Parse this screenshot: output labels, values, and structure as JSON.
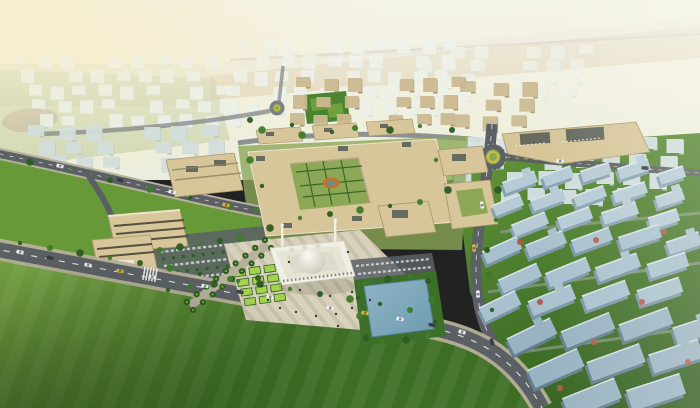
{
  "meta": {
    "type": "architectural-aerial-render",
    "subject": "campus-masterplan-with-central-mosque-plaza-pool-and-residential-districts"
  },
  "palette": {
    "sky_top": "#f5f1dc",
    "sky_low": "#ebeedd",
    "glow": "#f8e9b4",
    "desert": "#d7c6a2",
    "desert_light": "#e8decb",
    "horizon_green": "#ccd2ae",
    "haze": "#f4f3e9",
    "far_wall": "#eaf0ea",
    "far_shade": "#d0ddd8",
    "far_blue": "#d6e2e5",
    "far_blue_shade": "#b7ccd2",
    "midblue_wall": "#d3dfdc",
    "midblue_shade": "#b6c8c6",
    "tan_wall": "#ccba91",
    "tan_shade": "#a6926b",
    "campus_wall": "#d6c69a",
    "campus_shade": "#a8946d",
    "roof_dark": "#666a60",
    "roof_edge": "#ece3c8",
    "grass_campus": "#8ca857",
    "grass_west": "#679939",
    "lawn_hi": "#74a243",
    "lawn_lo": "#3e6d24",
    "resid_hi": "#5f9138",
    "resid_lo": "#2f5c1d",
    "tree_dark": "#2c5c22",
    "tree_mid": "#3f7a2a",
    "lime": "#a6d14d",
    "hedge": "#2f6322",
    "treebed": "#3c6f2a",
    "road": "#5b6065",
    "road_light": "#7b8084",
    "sidewalk": "#b7b09a",
    "path_light": "#98a29a",
    "plaza": "#d8d1bb",
    "plaza_stripe": "#c8c1ab",
    "mosque_wall": "#f0efe6",
    "mosque_mid": "#e6e4d5",
    "mosque_roof": "#dedbcb",
    "dome_hi": "#fbfaf3",
    "dome_lo": "#c8c5b4",
    "arch": "#8a8574",
    "pool_hi": "#8fb5c5",
    "pool_lo": "#6e9bb0",
    "pool_edge": "#54829a",
    "car_white": "#eff1f2",
    "car_dark": "#3c4248",
    "car_yellow": "#d7b93f",
    "glass": "#2d343a",
    "flower": "#b25a48",
    "yellow_ring": "#d3c03e",
    "white_edge": "#ebf1f5",
    "field": "#4a8430",
    "court": "#6da23e",
    "dirt": "#b9a88f",
    "person": "#3b3b36",
    "resid1_wall": "#b6cbd6",
    "resid1_side": "#89a2b0",
    "resid2_wall": "#a9c1ce",
    "resid2_side": "#7b96a5",
    "resid3_wall": "#99b3c2",
    "resid3_side": "#647f8e"
  },
  "scene": {
    "clusters": [
      {
        "name": "far-city-left",
        "layer": "g-far",
        "x": 15,
        "y": 56,
        "w": 212,
        "h": 74,
        "cols": 9,
        "rows": 5,
        "bw": 13,
        "bh": 9,
        "drift": 6,
        "wall": "far_wall",
        "shade": "far_shade",
        "opacity": 0.9
      },
      {
        "name": "far-city-center",
        "layer": "g-far",
        "x": 240,
        "y": 40,
        "w": 226,
        "h": 78,
        "cols": 10,
        "rows": 5,
        "bw": 13,
        "bh": 10,
        "drift": -4,
        "wall": "far_wall",
        "shade": "far_shade",
        "opacity": 0.92
      },
      {
        "name": "far-city-right-upper",
        "layer": "g-far",
        "x": 424,
        "y": 46,
        "w": 180,
        "h": 56,
        "cols": 7,
        "rows": 4,
        "bw": 14,
        "bh": 9,
        "drift": -6,
        "wall": "far_wall",
        "shade": "far_shade",
        "opacity": 0.7
      },
      {
        "name": "left-midrise-rows",
        "layer": "g-mid",
        "x": 30,
        "y": 126,
        "w": 200,
        "h": 46,
        "cols": 7,
        "rows": 3,
        "bw": 16,
        "bh": 11,
        "drift": 9,
        "wall": "midblue_wall",
        "shade": "midblue_shade",
        "opacity": 0.95
      },
      {
        "name": "north-tan-district",
        "layer": "g-mid",
        "x": 298,
        "y": 78,
        "w": 178,
        "h": 54,
        "cols": 7,
        "rows": 3,
        "bw": 14,
        "bh": 10,
        "drift": -5,
        "wall": "tan_wall",
        "shade": "tan_shade",
        "opacity": 0.95
      },
      {
        "name": "northeast-tan-blocks",
        "layer": "g-mid",
        "x": 462,
        "y": 82,
        "w": 92,
        "h": 50,
        "cols": 3,
        "rows": 3,
        "bw": 15,
        "bh": 11,
        "drift": -5,
        "wall": "tan_wall",
        "shade": "tan_shade",
        "opacity": 0.9
      },
      {
        "name": "east-district-far",
        "layer": "g-residfar",
        "x": 468,
        "y": 138,
        "w": 228,
        "h": 68,
        "cols": 8,
        "rows": 4,
        "bw": 17,
        "bh": 12,
        "drift": -8,
        "wall": "far_blue",
        "shade": "far_blue_shade",
        "opacity": 0.95
      }
    ],
    "residential_blocks": [
      [
        520,
        182,
        34,
        12,
        -20,
        1
      ],
      [
        558,
        176,
        30,
        12,
        -20,
        1
      ],
      [
        596,
        172,
        30,
        12,
        -18,
        1
      ],
      [
        634,
        169,
        32,
        12,
        -18,
        1
      ],
      [
        672,
        175,
        26,
        12,
        -18,
        1
      ],
      [
        508,
        205,
        30,
        12,
        -22,
        1
      ],
      [
        548,
        200,
        34,
        12,
        -20,
        1
      ],
      [
        590,
        196,
        32,
        12,
        -20,
        1
      ],
      [
        630,
        192,
        34,
        12,
        -18,
        1
      ],
      [
        670,
        198,
        28,
        12,
        -18,
        1
      ],
      [
        530,
        224,
        36,
        13,
        -22,
        1
      ],
      [
        575,
        218,
        34,
        13,
        -20,
        1
      ],
      [
        620,
        213,
        36,
        13,
        -18,
        1
      ],
      [
        664,
        219,
        30,
        13,
        -18,
        1
      ],
      [
        502,
        250,
        38,
        14,
        -24,
        2
      ],
      [
        546,
        244,
        40,
        14,
        -22,
        2
      ],
      [
        592,
        240,
        40,
        14,
        -20,
        2
      ],
      [
        640,
        237,
        42,
        14,
        -18,
        2
      ],
      [
        684,
        243,
        34,
        14,
        -18,
        2
      ],
      [
        520,
        278,
        42,
        15,
        -24,
        2
      ],
      [
        568,
        272,
        44,
        15,
        -22,
        2
      ],
      [
        618,
        267,
        44,
        15,
        -20,
        2
      ],
      [
        668,
        265,
        40,
        15,
        -18,
        2
      ],
      [
        500,
        306,
        40,
        16,
        -26,
        2
      ],
      [
        552,
        300,
        46,
        16,
        -22,
        2
      ],
      [
        606,
        295,
        46,
        16,
        -20,
        2
      ],
      [
        660,
        291,
        44,
        16,
        -18,
        2
      ],
      [
        532,
        336,
        48,
        18,
        -26,
        3
      ],
      [
        588,
        330,
        52,
        18,
        -22,
        3
      ],
      [
        646,
        324,
        52,
        18,
        -20,
        3
      ],
      [
        694,
        330,
        40,
        18,
        -18,
        3
      ],
      [
        556,
        368,
        54,
        20,
        -24,
        3
      ],
      [
        616,
        362,
        56,
        20,
        -20,
        3
      ],
      [
        676,
        356,
        52,
        20,
        -18,
        3
      ],
      [
        592,
        398,
        56,
        22,
        -22,
        3
      ],
      [
        656,
        392,
        56,
        22,
        -18,
        3
      ]
    ],
    "trees": [
      [
        20,
        243
      ],
      [
        50,
        248
      ],
      [
        80,
        253
      ],
      [
        110,
        258
      ],
      [
        140,
        263
      ],
      [
        170,
        268
      ],
      [
        200,
        274
      ],
      [
        230,
        279
      ],
      [
        260,
        284
      ],
      [
        290,
        289
      ],
      [
        320,
        294
      ],
      [
        350,
        299
      ],
      [
        380,
        304
      ],
      [
        410,
        310
      ],
      [
        30,
        162
      ],
      [
        70,
        171
      ],
      [
        110,
        180
      ],
      [
        150,
        189
      ],
      [
        190,
        198
      ],
      [
        230,
        207
      ],
      [
        498,
        190
      ],
      [
        496,
        220
      ],
      [
        487,
        250
      ],
      [
        489,
        275
      ],
      [
        492,
        310
      ],
      [
        366,
        283
      ],
      [
        388,
        279
      ],
      [
        410,
        276
      ],
      [
        428,
        281
      ],
      [
        432,
        300
      ],
      [
        435,
        322
      ],
      [
        428,
        336
      ],
      [
        406,
        340
      ],
      [
        382,
        342
      ],
      [
        366,
        338
      ],
      [
        360,
        316
      ],
      [
        358,
        298
      ],
      [
        160,
        250
      ],
      [
        180,
        247
      ],
      [
        200,
        244
      ],
      [
        220,
        241
      ],
      [
        240,
        238
      ],
      [
        168,
        290
      ],
      [
        190,
        287
      ],
      [
        214,
        284
      ],
      [
        238,
        281
      ],
      [
        258,
        278
      ],
      [
        250,
        160
      ],
      [
        262,
        186
      ],
      [
        256,
        210
      ],
      [
        270,
        228
      ],
      [
        300,
        218
      ],
      [
        330,
        214
      ],
      [
        360,
        210
      ],
      [
        390,
        206
      ],
      [
        420,
        202
      ],
      [
        448,
        190
      ],
      [
        436,
        160
      ],
      [
        250,
        120
      ],
      [
        262,
        130
      ],
      [
        292,
        125
      ],
      [
        355,
        128
      ],
      [
        390,
        130
      ],
      [
        420,
        126
      ],
      [
        452,
        130
      ],
      [
        302,
        135
      ],
      [
        332,
        132
      ]
    ],
    "flower_trees": [
      [
        540,
        302
      ],
      [
        594,
        342
      ],
      [
        642,
        302
      ],
      [
        596,
        240
      ],
      [
        664,
        232
      ],
      [
        560,
        388
      ],
      [
        520,
        242
      ],
      [
        688,
        362
      ]
    ],
    "cars": [
      [
        20,
        252,
        10,
        "car_white"
      ],
      [
        50,
        258,
        11,
        "car_dark"
      ],
      [
        88,
        265,
        11,
        "car_white"
      ],
      [
        120,
        271,
        11,
        "car_yellow"
      ],
      [
        152,
        277,
        11,
        "car_white"
      ],
      [
        205,
        286,
        11,
        "car_white"
      ],
      [
        240,
        292,
        11,
        "car_dark"
      ],
      [
        270,
        297,
        10,
        "car_white"
      ],
      [
        330,
        308,
        10,
        "car_white"
      ],
      [
        365,
        313,
        9,
        "car_yellow"
      ],
      [
        400,
        319,
        9,
        "car_white"
      ],
      [
        432,
        325,
        10,
        "car_dark"
      ],
      [
        462,
        332,
        16,
        "car_white"
      ],
      [
        482,
        205,
        84,
        "car_white"
      ],
      [
        474,
        248,
        86,
        "car_yellow"
      ],
      [
        478,
        294,
        88,
        "car_white"
      ],
      [
        492,
        342,
        70,
        "car_dark"
      ],
      [
        60,
        166,
        12,
        "car_white"
      ],
      [
        120,
        180,
        13,
        "car_dark"
      ],
      [
        172,
        192,
        13,
        "car_white"
      ],
      [
        226,
        205,
        13,
        "car_yellow"
      ],
      [
        560,
        161,
        3,
        "car_white"
      ],
      [
        645,
        168,
        3,
        "car_dark"
      ]
    ],
    "people": [
      [
        268,
        300
      ],
      [
        280,
        308
      ],
      [
        296,
        312
      ],
      [
        316,
        316
      ],
      [
        336,
        314
      ],
      [
        352,
        308
      ],
      [
        300,
        290
      ],
      [
        330,
        296
      ],
      [
        352,
        292
      ],
      [
        262,
        286
      ],
      [
        348,
        252
      ],
      [
        289,
        262
      ],
      [
        370,
        300
      ],
      [
        338,
        326
      ]
    ],
    "palm_avenue": {
      "x1": 190,
      "y1": 306,
      "x2": 268,
      "y2": 244,
      "count": 9,
      "offset": 5
    },
    "planters": {
      "x": 234,
      "y": 270,
      "rot": -8,
      "rows": 4,
      "cols": 3,
      "w": 11,
      "h": 7,
      "dx": 15,
      "dy": 10
    }
  }
}
